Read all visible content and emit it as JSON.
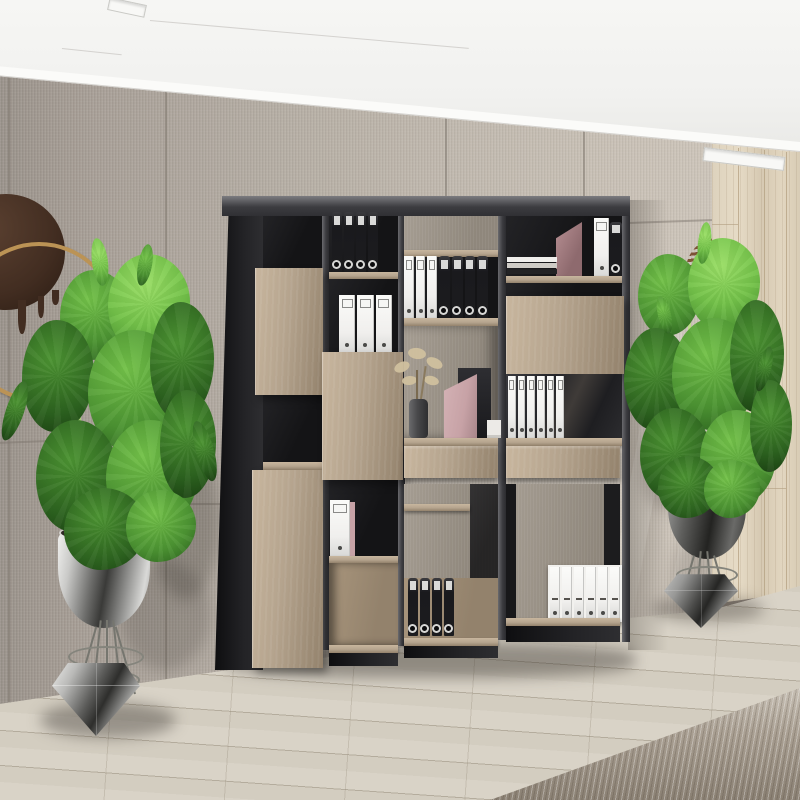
{
  "palette": {
    "ceiling": "#f1f1ef",
    "ceiling_shadow": "#e6e6e3",
    "wall_light": "#cdc5ba",
    "wall_mid": "#b4ada3",
    "wall_dark": "#9a938b",
    "seam": "#7f7870",
    "wood_wall_light": "#e6dbc6",
    "wood_wall_dark": "#d6c9b2",
    "wood_seam": "#b09c7e",
    "frame_dark": "#141416",
    "frame_mid": "#3c3c40",
    "frame_light": "#6a6a6e",
    "oak": "#b5a48e",
    "oak_light": "#c8b69e",
    "oak_dark": "#93826c",
    "binder_black": "#1c1c1f",
    "binder_white": "#f0efed",
    "label_white": "#e9e9e7",
    "file_pink": "#c7a2a6",
    "plant_dark": "#2e6420",
    "plant_mid": "#4d9433",
    "plant_light": "#74c24a",
    "pot_dark": "#3a3a38",
    "pot_right_dark": "#232321",
    "gold": "#bb9355",
    "decor_brown": "#422d21",
    "floor": "#d9d3c7",
    "rug_light": "#cdc6bb",
    "rug_dark": "#8a8073",
    "soil": "#2e2a24"
  },
  "counts": {
    "black_binders_top": 4,
    "white_binders_upper": 3,
    "white_binders_mid": 3,
    "black_binders_mid": 4,
    "book_stack": 3,
    "white_binders_row": 6,
    "black_binders_bottom": 4,
    "white_box_spines": 6
  },
  "inventory": {
    "bookshelf_columns": 4,
    "oak_doors": 4,
    "drawers": 2,
    "plants": 2,
    "wall_rings": 2
  }
}
